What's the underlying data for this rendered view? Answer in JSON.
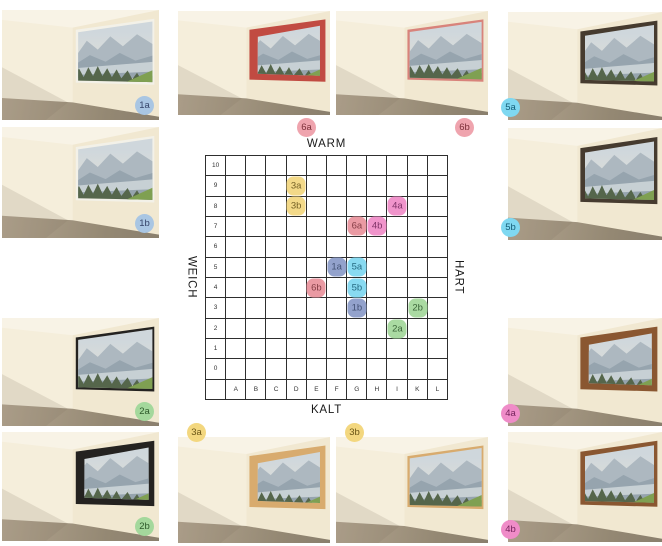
{
  "chart_data": {
    "type": "scatter",
    "title": "",
    "x_categories": [
      "A",
      "B",
      "C",
      "D",
      "E",
      "F",
      "G",
      "H",
      "I",
      "K",
      "L"
    ],
    "y_ticks": [
      "10",
      "9",
      "8",
      "7",
      "6",
      "5",
      "4",
      "3",
      "2",
      "1",
      "0"
    ],
    "y_range": [
      0,
      10
    ],
    "grid": true,
    "axis_labels": {
      "top": "WARM",
      "bottom": "KALT",
      "left": "WEICH",
      "right": "HART"
    },
    "points": [
      {
        "label": "1a",
        "x": "F",
        "y": 5,
        "group": "1"
      },
      {
        "label": "1b",
        "x": "G",
        "y": 3,
        "group": "1"
      },
      {
        "label": "2a",
        "x": "I",
        "y": 2,
        "group": "2"
      },
      {
        "label": "2b",
        "x": "K",
        "y": 3,
        "group": "2"
      },
      {
        "label": "3a",
        "x": "D",
        "y": 9,
        "group": "3"
      },
      {
        "label": "3b",
        "x": "D",
        "y": 8,
        "group": "3"
      },
      {
        "label": "4a",
        "x": "I",
        "y": 8,
        "group": "4"
      },
      {
        "label": "4b",
        "x": "H",
        "y": 7,
        "group": "4"
      },
      {
        "label": "5a",
        "x": "G",
        "y": 5,
        "group": "5"
      },
      {
        "label": "5b",
        "x": "G",
        "y": 4,
        "group": "5"
      },
      {
        "label": "6a",
        "x": "G",
        "y": 7,
        "group": "6"
      },
      {
        "label": "6b",
        "x": "E",
        "y": 4,
        "group": "6"
      }
    ]
  },
  "groups": {
    "1": {
      "marker_color": "#8b9cc9",
      "badge_color": "#a9c6e3",
      "text_color": "#36456a",
      "frame_color": "#f3f1e8",
      "frame": "white"
    },
    "2": {
      "marker_color": "#a4d89c",
      "badge_color": "#a4d89c",
      "text_color": "#2e5a2b",
      "frame_color": "#242220",
      "frame": "black"
    },
    "3": {
      "marker_color": "#f3d77f",
      "badge_color": "#f3d77f",
      "text_color": "#6a5516",
      "frame_color": "#d8ab6e",
      "frame": "light-wood"
    },
    "4": {
      "marker_color": "#ef8cc8",
      "badge_color": "#ef8cc8",
      "text_color": "#76245d",
      "frame_color": "#8a5731",
      "frame": "brown-wood"
    },
    "5": {
      "marker_color": "#7fd8f1",
      "badge_color": "#7fd8f1",
      "text_color": "#155e78",
      "frame_color": "#463b2f",
      "frame": "dark-wood"
    },
    "6": {
      "marker_color": "#e9939d",
      "badge_color": "#efa4ae",
      "text_color": "#7c3039",
      "frame_color": "#c14b42",
      "frame": "red"
    }
  },
  "rooms": [
    {
      "id": "1a",
      "group": "1",
      "thickness": "thin",
      "badge_pos": "br-in"
    },
    {
      "id": "6a",
      "group": "6",
      "thickness": "thick",
      "badge_pos": "below-right"
    },
    {
      "id": "6b",
      "group": "6",
      "thickness": "thin",
      "frame_color": "#d8837b",
      "badge_pos": "below-right"
    },
    {
      "id": "5a",
      "group": "5",
      "thickness": "med",
      "badge_pos": "bl-edge"
    },
    {
      "id": "1b",
      "group": "1",
      "thickness": "thin",
      "badge_pos": "br-in"
    },
    {
      "id": "5b",
      "group": "5",
      "thickness": "med",
      "badge_pos": "bl-edge"
    },
    {
      "id": "2a",
      "group": "2",
      "thickness": "thin",
      "badge_pos": "br-in"
    },
    {
      "id": "4a",
      "group": "4",
      "thickness": "thick",
      "badge_pos": "bl-edge"
    },
    {
      "id": "2b",
      "group": "2",
      "thickness": "thick",
      "badge_pos": "br-in"
    },
    {
      "id": "3a",
      "group": "3",
      "thickness": "thick",
      "badge_pos": "tl-edge"
    },
    {
      "id": "3b",
      "group": "3",
      "thickness": "thin",
      "badge_pos": "tl-edge"
    },
    {
      "id": "4b",
      "group": "4",
      "thickness": "med",
      "badge_pos": "bl-edge"
    }
  ]
}
